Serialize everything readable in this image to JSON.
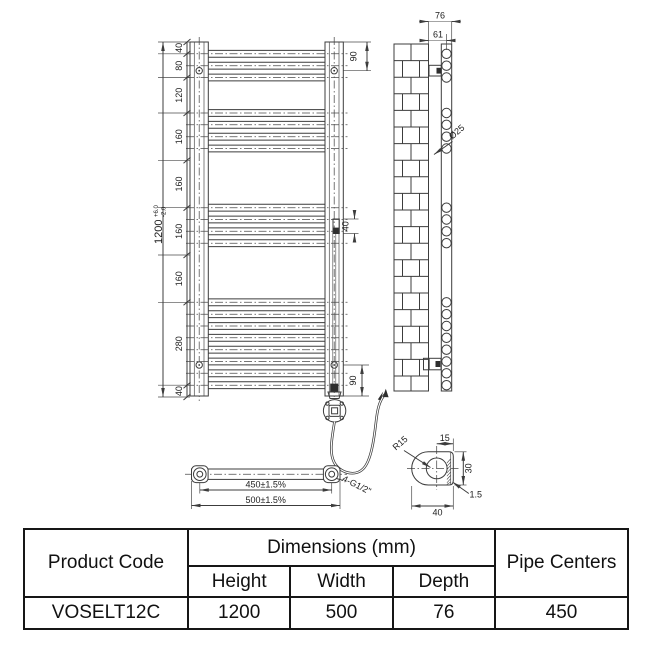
{
  "drawing": {
    "front_view": {
      "overall": {
        "value": "1200",
        "tol_plus": "+6.0",
        "tol_minus": "-2.0"
      },
      "chain": [
        "40",
        "80",
        "120",
        "160",
        "160",
        "160",
        "160",
        "280",
        "40"
      ],
      "bracket_top": "90",
      "element_offset": "40",
      "bracket_bottom": "90"
    },
    "side_view": {
      "depth": "76",
      "tube_offset": "61",
      "tube_diameter": "Ø25"
    },
    "plan_view": {
      "pipe_centers": "450±1.5%",
      "overall_width": "500±1.5%",
      "thread": "4-G1/2\""
    },
    "detail_view": {
      "radius": "R15",
      "center_to_face": "15",
      "height": "30",
      "wall": "1.5",
      "width": "40"
    }
  },
  "geometry": {
    "top_y": 42,
    "px_per_mm": 0.29583,
    "tube_groups": [
      {
        "start_mm": 40,
        "count": 3,
        "pitch_mm": 40
      },
      {
        "start_mm": 240,
        "count": 4,
        "pitch_mm": 40
      },
      {
        "start_mm": 560,
        "count": 4,
        "pitch_mm": 40
      },
      {
        "start_mm": 880,
        "count": 8,
        "pitch_mm": 40
      }
    ]
  },
  "table": {
    "header": {
      "product_code": "Product Code",
      "dimensions_group": "Dimensions (mm)",
      "height": "Height",
      "width": "Width",
      "depth": "Depth",
      "pipe_centers": "Pipe Centers"
    },
    "rows": [
      {
        "product_code": "VOSELT12C",
        "height": "1200",
        "width": "500",
        "depth": "76",
        "pipe_centers": "450"
      }
    ]
  }
}
